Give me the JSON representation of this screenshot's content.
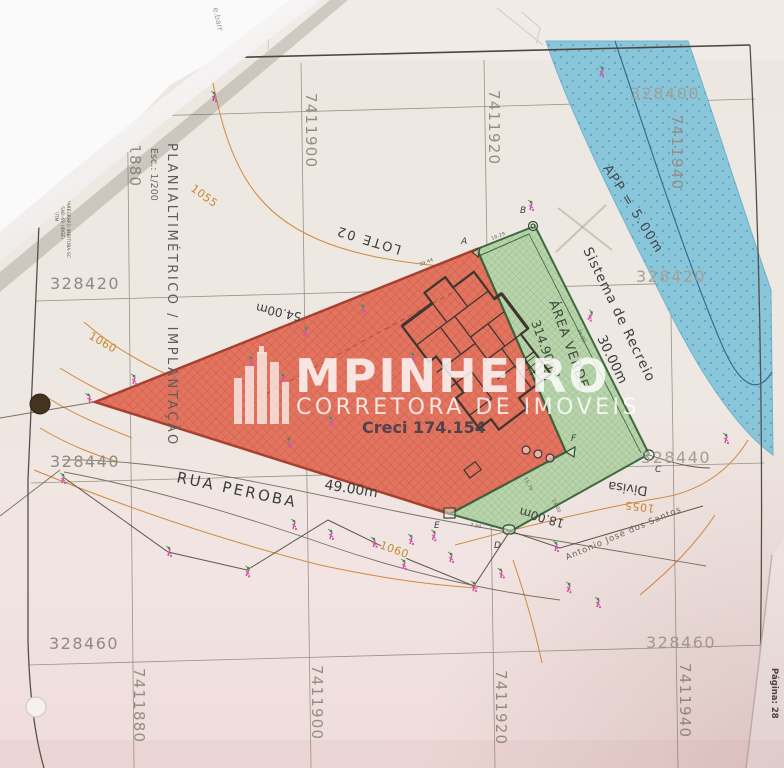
{
  "watermark": {
    "brand": "MPINHEIRO",
    "subtitle": "CORRETORA DE IMOVEIS",
    "creci": "Creci 174.154"
  },
  "titleblock": {
    "title": "PLANIALTIMÉTRICO / IMPLANTAÇÃO",
    "scale": "Esc.: 1/200",
    "note1": "SISTEMA DE PROJEÇÃO UTM",
    "note2": "DATUM HORIZONTAL SAD-69 (IBGE)",
    "note3": "DATUM VERTICAL MARÉGRAFO IMBITUBA-SC"
  },
  "grid": {
    "e1": "328400",
    "e2": "328420",
    "e3": "328440",
    "e4": "328460",
    "n1": "7411880",
    "n2": "7411900",
    "n3": "7411920",
    "n4": "7411940"
  },
  "labels": {
    "lot": "LOTE 02",
    "street": "RUA PEROBA",
    "front_dim": "49.00m",
    "side_dim": "54.00m",
    "back_dim": "18.00m",
    "divisa": "Divisa",
    "recreation": "Sistema de Recreio",
    "recreation_dim": "30.00m",
    "green_area": "ÁREA VERDE",
    "green_area_size": "314.90m²",
    "app": "APP = 5.00m",
    "neighbor": "Antonio José dos Santos"
  },
  "contours": {
    "c1": "1055",
    "c2": "1060",
    "c3": "1060",
    "c4": "1055"
  },
  "corners": {
    "a": "A",
    "b": "B",
    "c": "C",
    "d": "D",
    "e": "E",
    "f": "F"
  },
  "dims": {
    "d1": "39.44",
    "d2": "10.29",
    "d3": "30.00",
    "d4": "15.70",
    "d5": "14.00",
    "d6": "7.50",
    "d7": "7.60"
  },
  "page": {
    "number": "Página: 28",
    "curl_note": "e.barr"
  }
}
